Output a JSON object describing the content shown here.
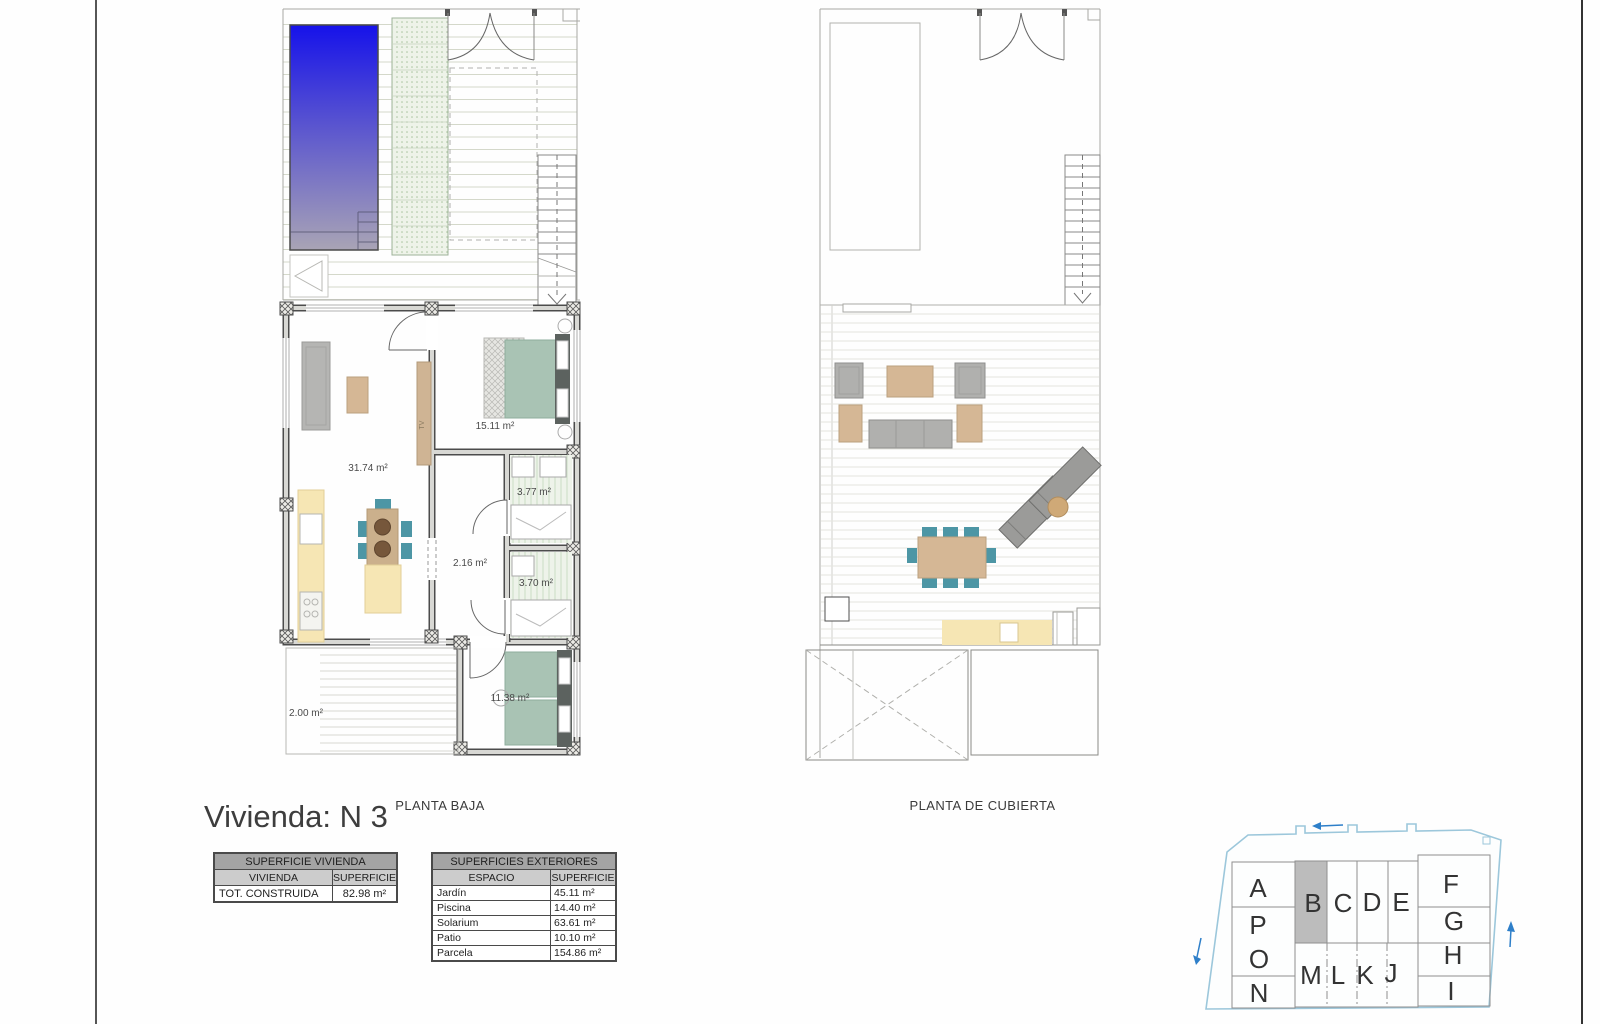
{
  "sheet": {
    "title": "Vivienda: N 3"
  },
  "plans": {
    "planta_baja": {
      "label": "PLANTA BAJA",
      "rooms": {
        "living": "31.74 m²",
        "bedroom_main": "15.11 m²",
        "bath_1": "3.77 m²",
        "hall": "2.16 m²",
        "bath_2": "3.70 m²",
        "bedroom_2": "11.38 m²",
        "patio": "2.00 m²"
      },
      "tv_label": "TV"
    },
    "planta_cubierta": {
      "label": "PLANTA DE CUBIERTA"
    }
  },
  "tables": {
    "superficie_vivienda": {
      "title": "SUPERFICIE VIVIENDA",
      "columns": [
        "VIVIENDA",
        "SUPERFICIE"
      ],
      "rows": [
        {
          "label": "TOT. CONSTRUIDA",
          "value": "82.98 m²"
        }
      ]
    },
    "superficies_exteriores": {
      "title": "SUPERFICIES EXTERIORES",
      "columns": [
        "ESPACIO",
        "SUPERFICIE"
      ],
      "rows": [
        {
          "label": "Jardín",
          "value": "45.11 m²"
        },
        {
          "label": "Piscina",
          "value": "14.40 m²"
        },
        {
          "label": "Solarium",
          "value": "63.61 m²"
        },
        {
          "label": "Patio",
          "value": "10.10 m²"
        },
        {
          "label": "Parcela",
          "value": "154.86 m²"
        }
      ]
    }
  },
  "site_plan": {
    "highlighted_unit": "B",
    "units_left": [
      "A",
      "P",
      "O",
      "N"
    ],
    "units_top": [
      "B",
      "C",
      "D",
      "E"
    ],
    "units_bottom": [
      "M",
      "L",
      "K",
      "J"
    ],
    "units_right": [
      "F",
      "G",
      "H",
      "I"
    ]
  },
  "colors": {
    "pool_blue": "#1612ea",
    "bed_green": "#a9c3b4",
    "chair_teal": "#4d96a5",
    "wood_tan": "#d5b795",
    "counter_yellow": "#f6e6b4",
    "highlight_gray": "#bcbcbc",
    "site_outline_blue": "#9cc7db",
    "arrow_blue": "#2e7fc9"
  }
}
